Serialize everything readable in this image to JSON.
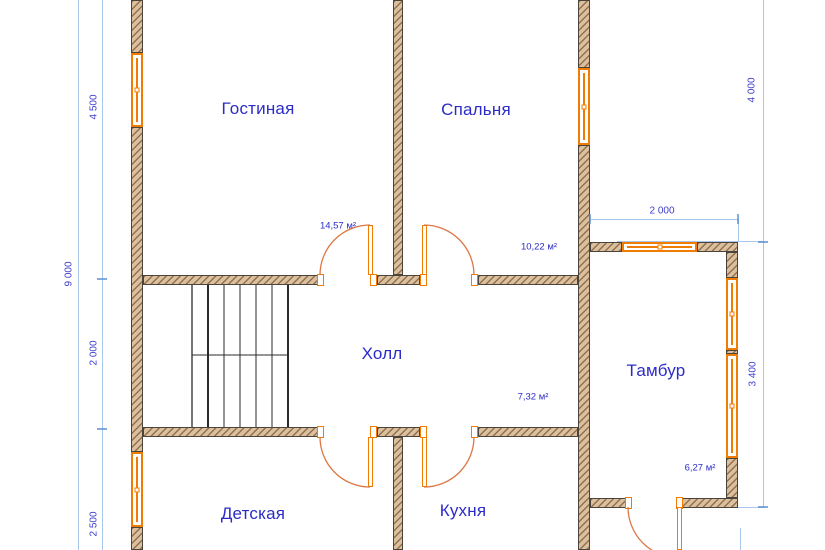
{
  "colors": {
    "wall_fill": "#d9c09e",
    "wall_hatch": "#96704e",
    "window_accent": "#f07c04",
    "door_accent": "#dd7744",
    "dimension_line": "#a9c7e8",
    "dim_tick": "#5b8fd0",
    "text_blue": "#2b2bc8",
    "dim_text": "#3c3ccc"
  },
  "rooms": {
    "living": {
      "label": "Гостиная",
      "area": "14,57 м²"
    },
    "bedroom": {
      "label": "Спальня",
      "area": "10,22 м²"
    },
    "hall": {
      "label": "Холл",
      "area": "7,32 м²"
    },
    "vestibule": {
      "label": "Тамбур",
      "area": "6,27 м²"
    },
    "nursery": {
      "label": "Детская"
    },
    "kitchen": {
      "label": "Кухня"
    }
  },
  "dimensions": {
    "left_total": "9 000",
    "left_top": "4 500",
    "left_middle": "2 000",
    "left_bottom": "2 500",
    "right_top": "4 000",
    "vestibule_height": "3 400",
    "vestibule_width": "2 000"
  }
}
